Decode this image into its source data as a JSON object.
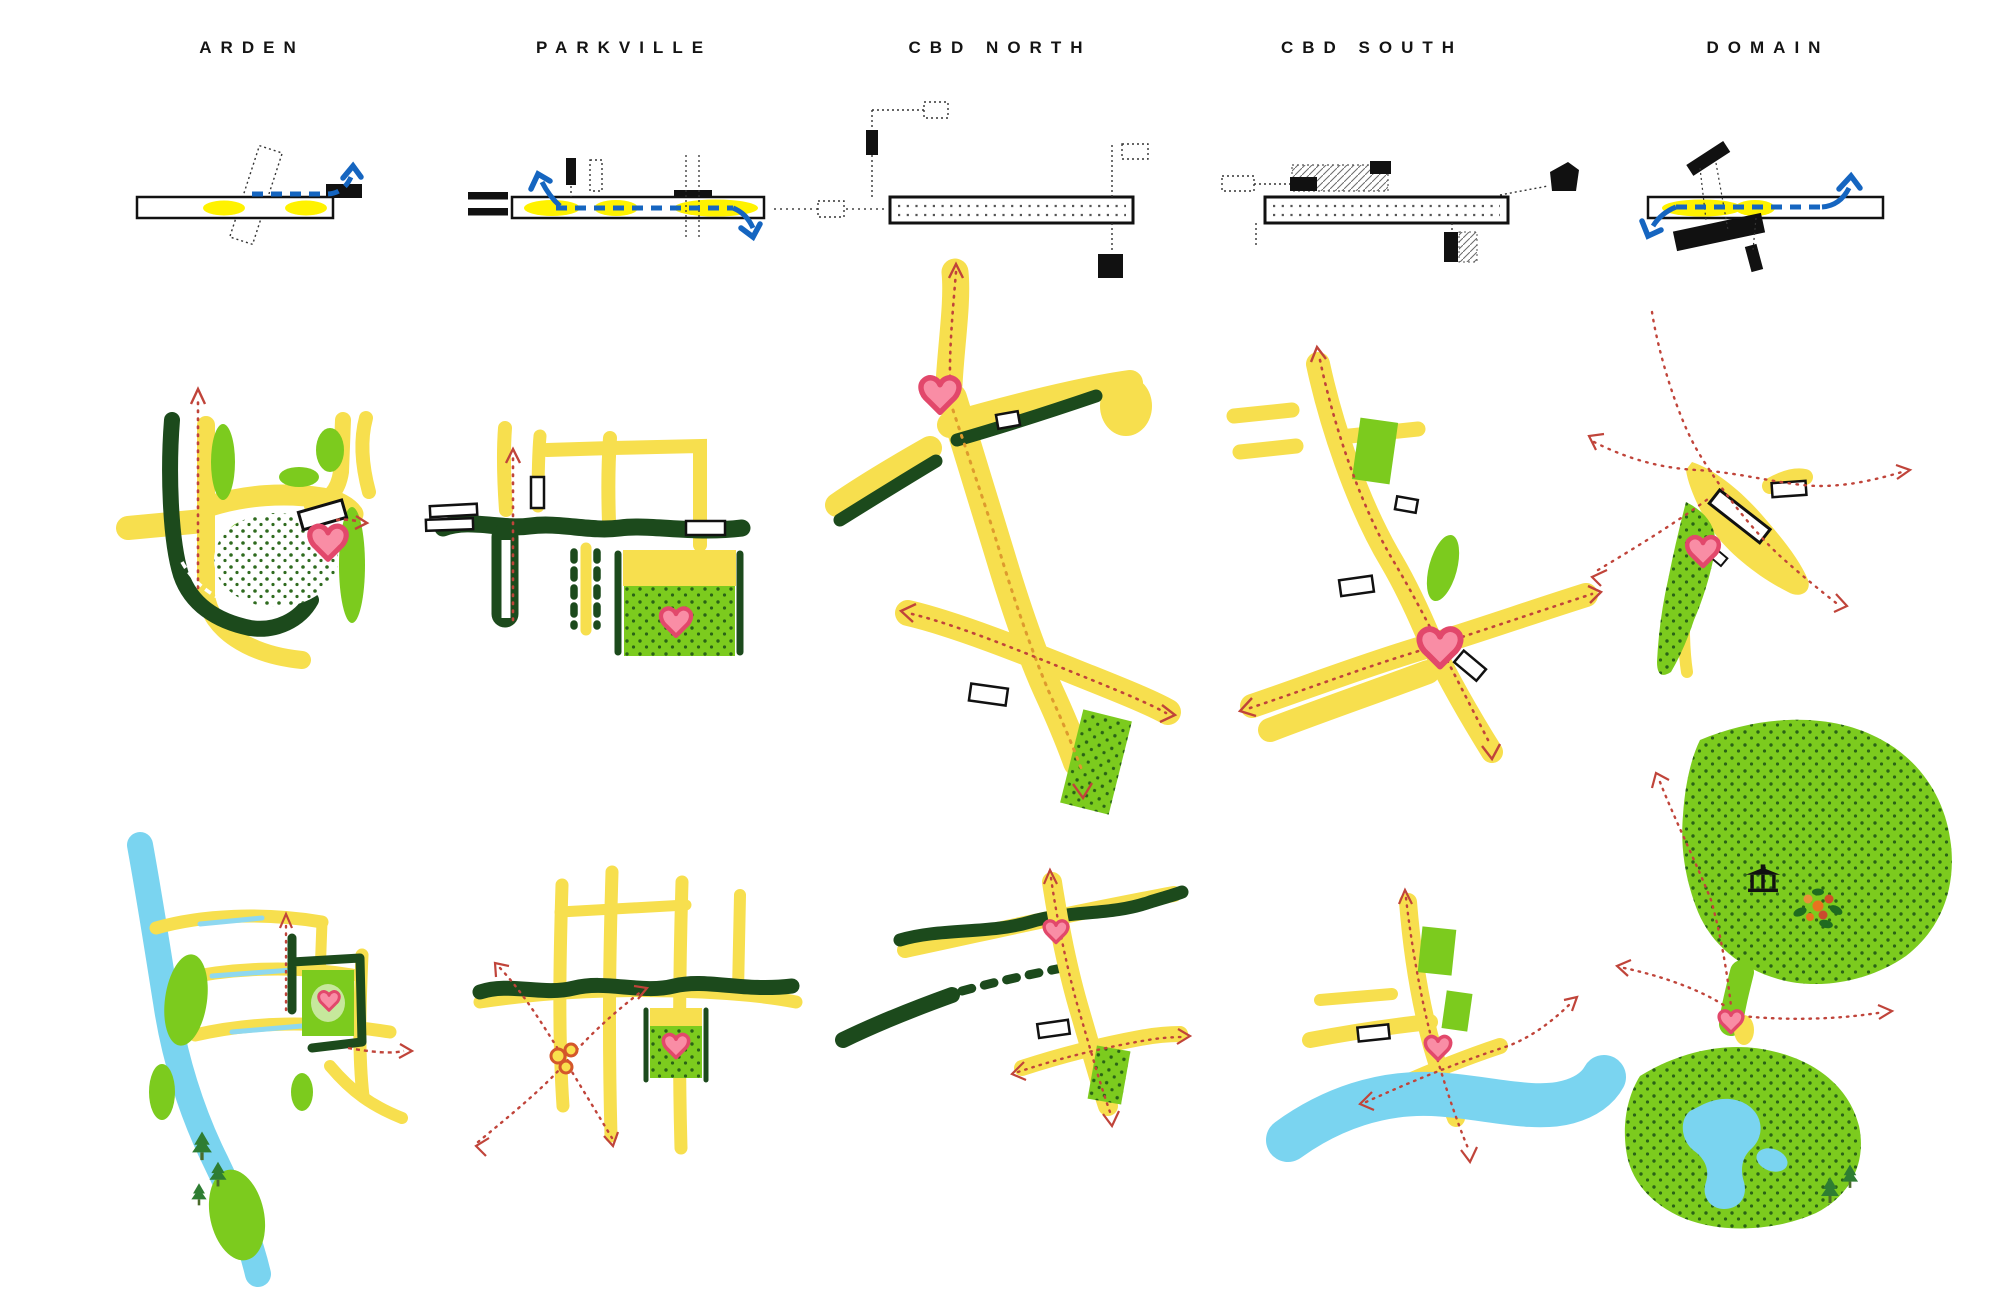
{
  "sheet": {
    "kind": "station precinct diagram sheet",
    "columns": [
      {
        "id": "arden",
        "label": "ARDEN"
      },
      {
        "id": "parkville",
        "label": "PARKVILLE"
      },
      {
        "id": "cbd-north",
        "label": "CBD NORTH"
      },
      {
        "id": "cbd-south",
        "label": "CBD SOUTH"
      },
      {
        "id": "domain",
        "label": "DOMAIN"
      }
    ],
    "palette": {
      "road_yellow": "#F7DF4E",
      "highlight_yellow": "#FFF200",
      "park_green": "#7CCB1E",
      "light_green": "#C6E89C",
      "tree_dark_green": "#1C4A1C",
      "stipple_dot_green": "#2A6316",
      "water_blue": "#7AD4F0",
      "transit_blue": "#1565C0",
      "heart_pink": "#F98DA5",
      "heart_outline": "#E2486B",
      "desire_line_red": "#C0443A",
      "road_dot_orange": "#DE9A2E",
      "ink": "#141414"
    },
    "icons": [
      "station-heart-icon",
      "transit-flow-arrow-icon",
      "desire-line-arrow-icon",
      "building-footprint-icon",
      "tree-icon",
      "pavilion-icon",
      "flower-cluster-icon",
      "station-circles-icon"
    ]
  }
}
